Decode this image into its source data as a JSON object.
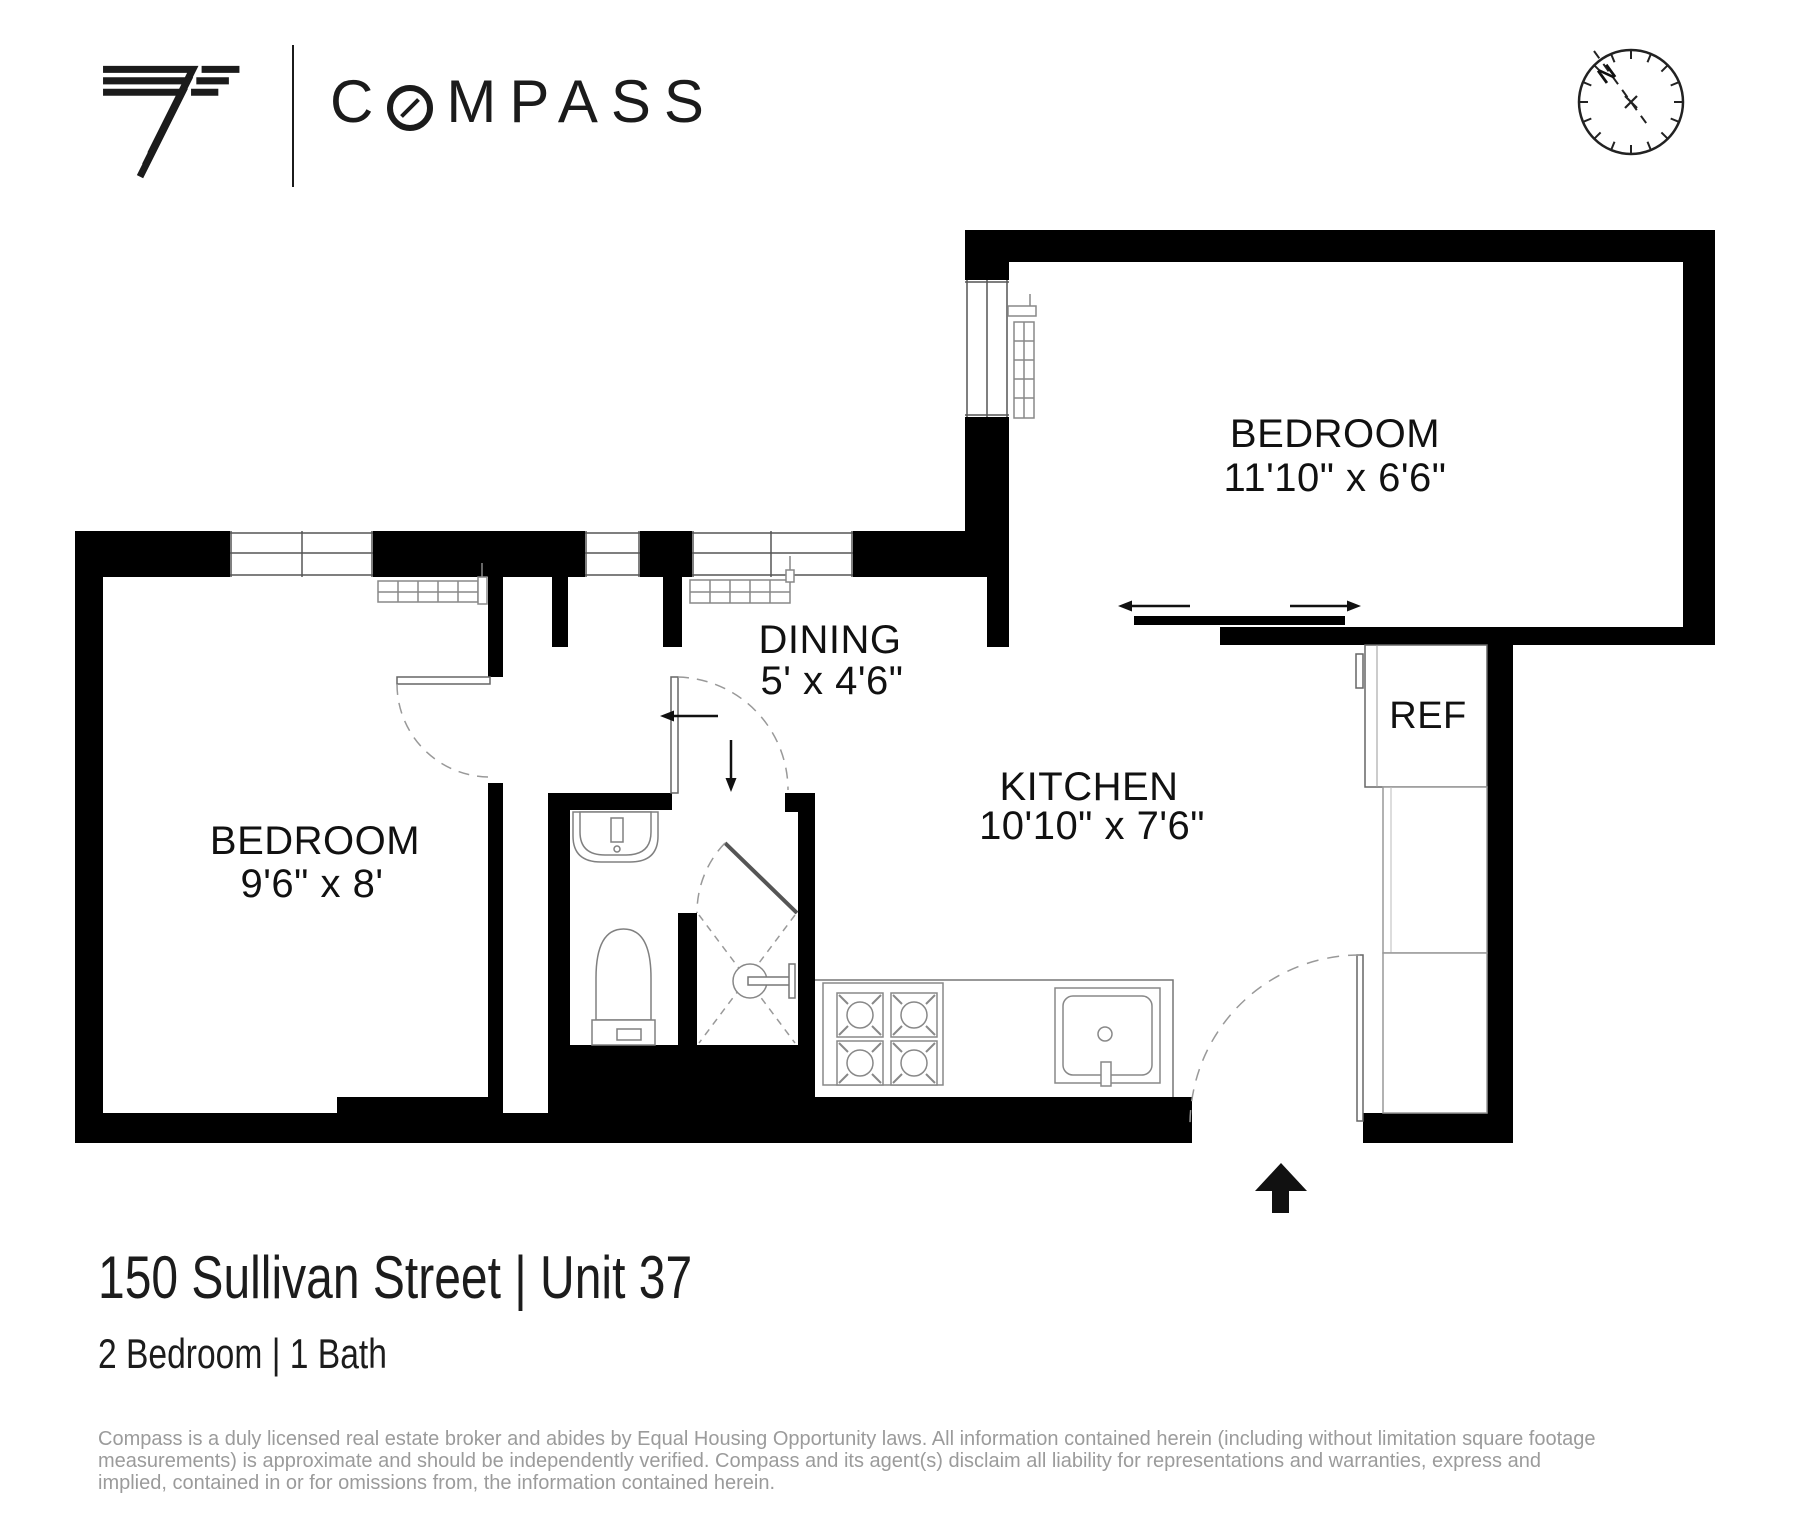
{
  "header": {
    "wordmark": {
      "first_letter": "C",
      "rest": "MPASS"
    }
  },
  "compass_rose": {
    "north_label": "N"
  },
  "floor_plan": {
    "rooms": [
      {
        "name": "BEDROOM",
        "dimensions": "11'10\" x 6'6\""
      },
      {
        "name": "DINING",
        "dimensions": "5' x 4'6\""
      },
      {
        "name": "KITCHEN",
        "dimensions": "10'10\" x 7'6\""
      },
      {
        "name": "BEDROOM",
        "dimensions": "9'6\" x 8'"
      }
    ],
    "labels": {
      "refrigerator": "REF"
    }
  },
  "footer": {
    "address": "150 Sullivan Street | Unit 37",
    "unit_info": "2 Bedroom | 1 Bath",
    "disclaimer_lines": [
      "Compass is a duly licensed real estate broker and abides by Equal Housing Opportunity laws. All information contained herein (including without limitation square footage",
      "measurements) is approximate and should be independently verified. Compass and its agent(s) disclaim all liability for representations and warranties, express and",
      "implied, contained in or for omissions from, the information contained herein."
    ]
  }
}
